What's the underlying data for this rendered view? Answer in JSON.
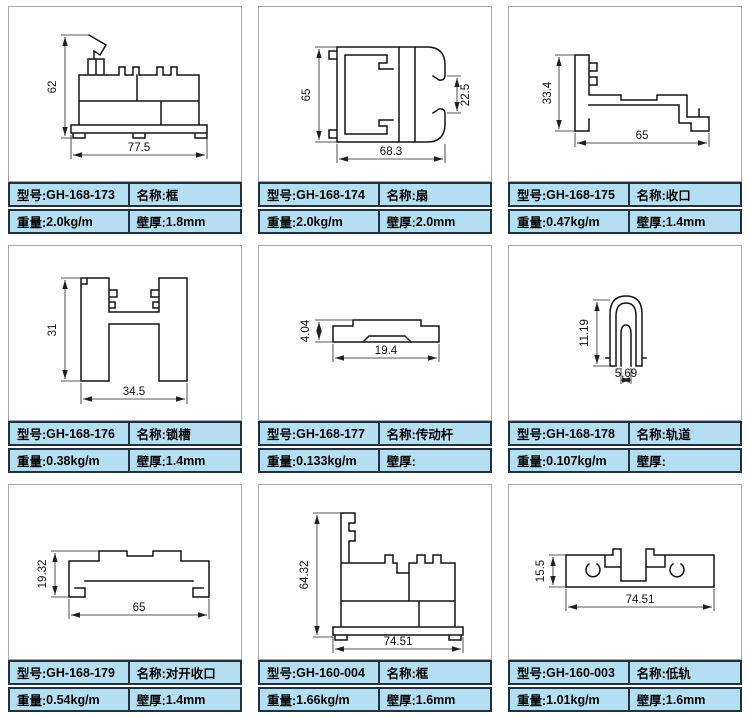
{
  "labels": {
    "model": "型号:",
    "name": "名称:",
    "weight": "重量:",
    "thickness": "壁厚:"
  },
  "colors": {
    "table_fill": "#b4def1",
    "table_border": "#22313f",
    "panel_border": "#a9a9a9",
    "line_color": "#141414"
  },
  "panels": [
    {
      "model": "GH-168-173",
      "name": "框",
      "weight": "2.0kg/m",
      "thickness": "1.8mm",
      "dims": {
        "v": "62",
        "h": "77.5"
      }
    },
    {
      "model": "GH-168-174",
      "name": "扇",
      "weight": "2.0kg/m",
      "thickness": "2.0mm",
      "dims": {
        "v": "65",
        "v2": "22.5",
        "h": "68.3"
      }
    },
    {
      "model": "GH-168-175",
      "name": "收口",
      "weight": "0.47kg/m",
      "thickness": "1.4mm",
      "dims": {
        "v": "33.4",
        "h": "65"
      }
    },
    {
      "model": "GH-168-176",
      "name": "锁槽",
      "weight": "0.38kg/m",
      "thickness": "1.4mm",
      "dims": {
        "v": "31",
        "h": "34.5"
      }
    },
    {
      "model": "GH-168-177",
      "name": "传动杆",
      "weight": "0.133kg/m",
      "thickness": "",
      "dims": {
        "v": "4.04",
        "h": "19.4"
      }
    },
    {
      "model": "GH-168-178",
      "name": "轨道",
      "weight": "0.107kg/m",
      "thickness": "",
      "dims": {
        "v": "11.19",
        "h": "5.69"
      }
    },
    {
      "model": "GH-168-179",
      "name": "对开收口",
      "weight": "0.54kg/m",
      "thickness": "1.4mm",
      "dims": {
        "v": "19.32",
        "h": "65"
      }
    },
    {
      "model": "GH-160-004",
      "name": "框",
      "weight": "1.66kg/m",
      "thickness": "1.6mm",
      "dims": {
        "v": "64.32",
        "h": "74.51"
      }
    },
    {
      "model": "GH-160-003",
      "name": "低轨",
      "weight": "1.01kg/m",
      "thickness": "1.6mm",
      "dims": {
        "v": "15.5",
        "h": "74.51"
      }
    }
  ]
}
